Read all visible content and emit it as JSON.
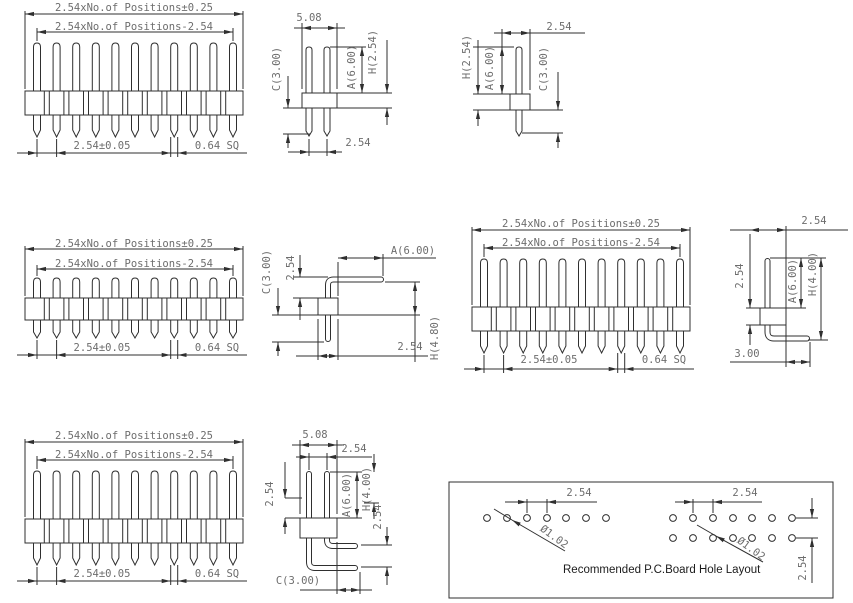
{
  "colors": {
    "line": "#2f2f2f",
    "dim_text": "#6d6d6d",
    "title_text": "#1c1c1c"
  },
  "views": {
    "front": {
      "overall": "2.54xNo.of Positions±0.25",
      "inner": "2.54xNo.of Positions-2.54",
      "pitch": "2.54±0.05",
      "pin": "0.64 SQ"
    },
    "side_straight": {
      "width": "5.08",
      "c": "C(3.00)",
      "a": "A(6.00)",
      "h": "H(2.54)",
      "pitch": "2.54"
    },
    "side_straight_single": {
      "pitch": "2.54",
      "h": "H(2.54)",
      "a": "A(6.00)",
      "c": "C(3.00)"
    },
    "side_angle": {
      "c": "C(3.00)",
      "riser": "2.54",
      "a": "A(6.00)",
      "h": "H(4.80)",
      "body": "2.54"
    },
    "side_angle_single": {
      "top": "2.54",
      "body": "2.54",
      "a": "A(6.00)",
      "h": "H(4.00)",
      "tail": "3.00"
    },
    "side_angle_dual": {
      "width": "5.08",
      "row": "2.54",
      "left": "2.54",
      "a": "A(6.00)",
      "h": "H(4.00)",
      "right": "2.54",
      "c": "C(3.00)"
    },
    "pcb": {
      "title": "Recommended P.C.Board Hole Layout",
      "pitch_left": "2.54",
      "dia_left": "Ø1.02",
      "pitch_right": "2.54",
      "dia_right": "Ø1.02",
      "row": "2.54"
    }
  }
}
